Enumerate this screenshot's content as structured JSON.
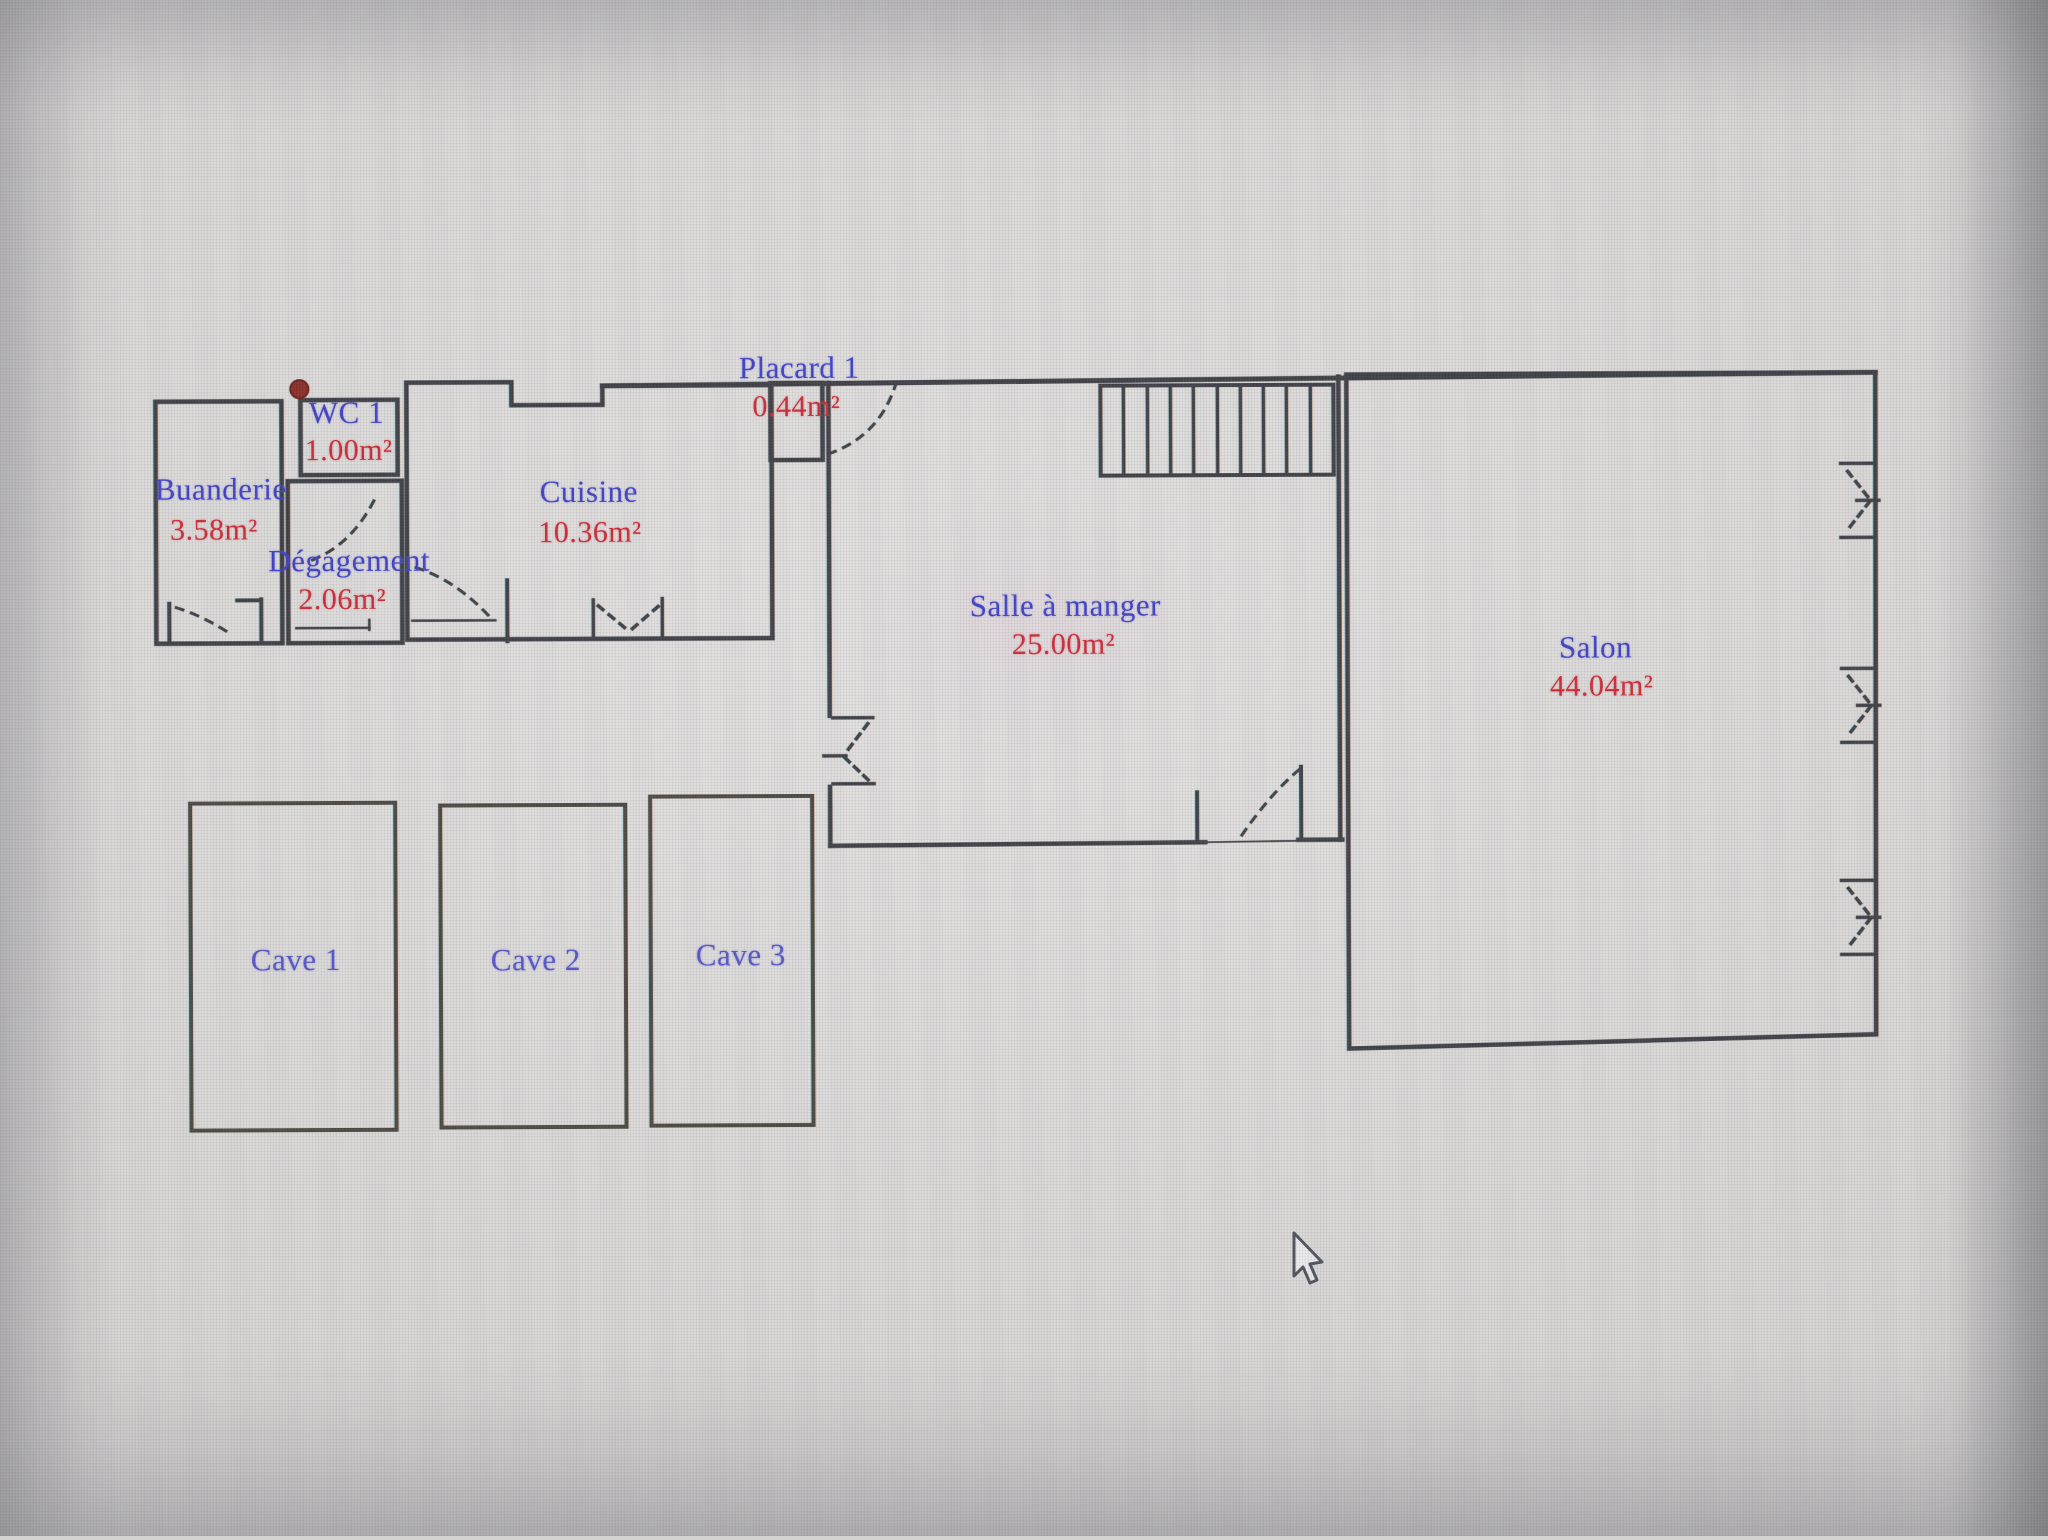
{
  "app": {
    "type": "floor-plan-drawing",
    "background": "#d6d4d2"
  },
  "palette": {
    "wall": "#3c3d43",
    "cave_wall": "#4a463f",
    "room_name_color": "#3d3fc4",
    "room_area_color": "#cc2733",
    "marker_red": "#8a2822"
  },
  "rooms": [
    {
      "name": "Buanderie",
      "area": "3.58m²"
    },
    {
      "name": "WC 1",
      "area": "1.00m²"
    },
    {
      "name": "Dégagement",
      "area": "2.06m²"
    },
    {
      "name": "Cuisine",
      "area": "10.36m²"
    },
    {
      "name": "Placard 1",
      "area": "0.44m²"
    },
    {
      "name": "Salle à manger",
      "area": "25.00m²"
    },
    {
      "name": "Salon",
      "area": "44.04m²"
    },
    {
      "name": "Cave 1",
      "area": ""
    },
    {
      "name": "Cave 2",
      "area": ""
    },
    {
      "name": "Cave 3",
      "area": ""
    }
  ],
  "symbols": {
    "stairs": "stairs-hatched-block",
    "door_arc": "door-swing-dashed-arc",
    "window": "window-double-tick-symbol",
    "vertex_marker": "red-vertex-dot",
    "cursor": "arrow-pointer"
  }
}
